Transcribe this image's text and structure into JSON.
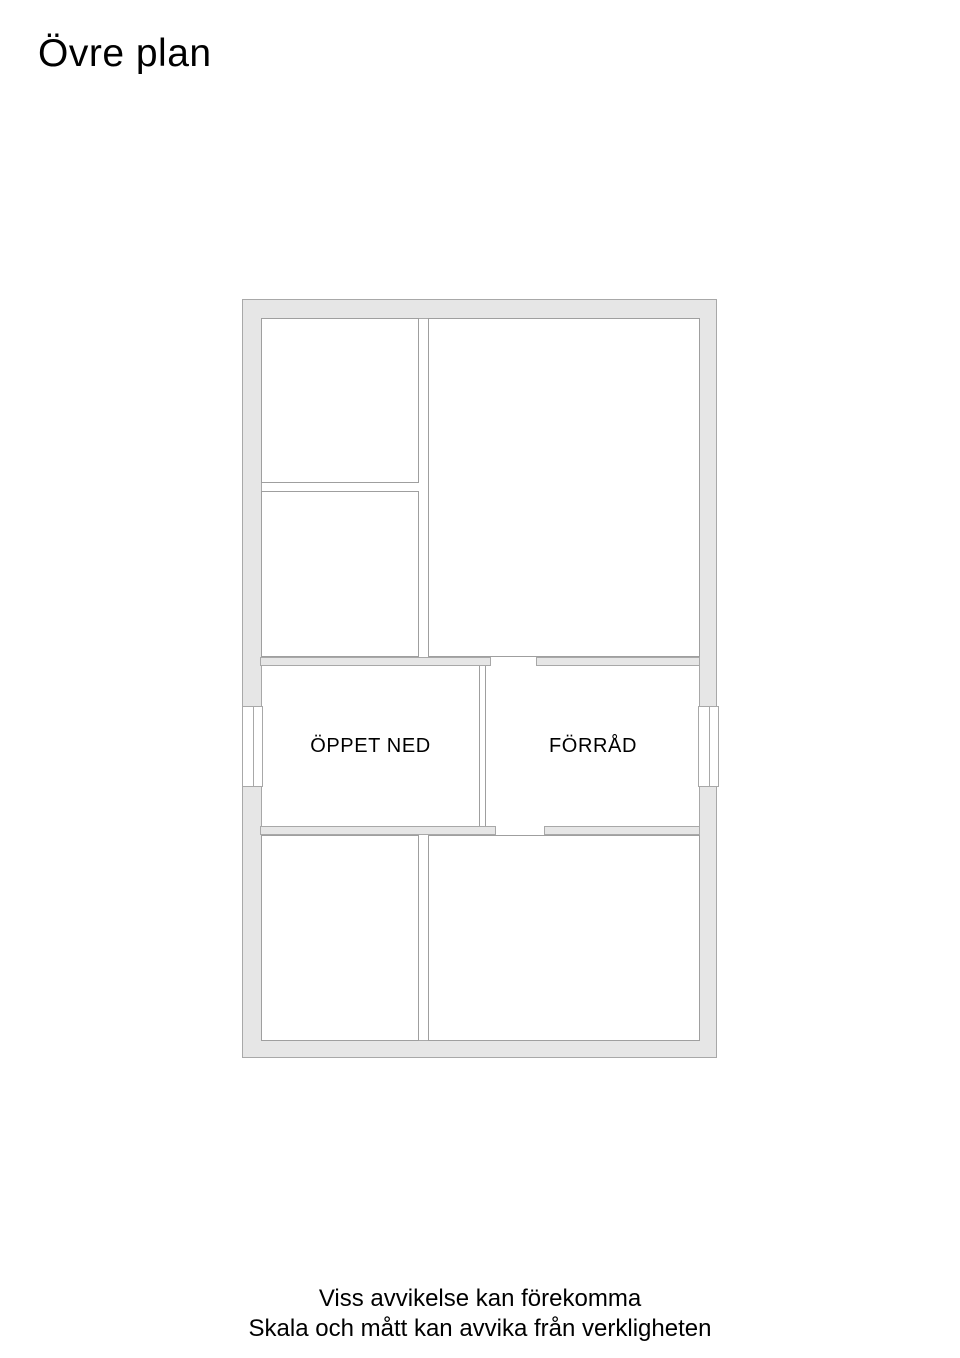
{
  "page": {
    "title": "Övre plan"
  },
  "floorplan": {
    "name": "upper-floor-plan",
    "room_labels": {
      "oppet_ned": "ÖPPET NED",
      "forrad": "FÖRRÅD"
    },
    "colors": {
      "wall_fill": "#e6e6e6",
      "wall_stroke": "#a8a8a8",
      "room_border": "#9f9f9f",
      "text": "#000000",
      "background": "#ffffff"
    }
  },
  "footer": {
    "line1": "Viss avvikelse kan förekomma",
    "line2": "Skala och mått kan avvika från verkligheten"
  }
}
